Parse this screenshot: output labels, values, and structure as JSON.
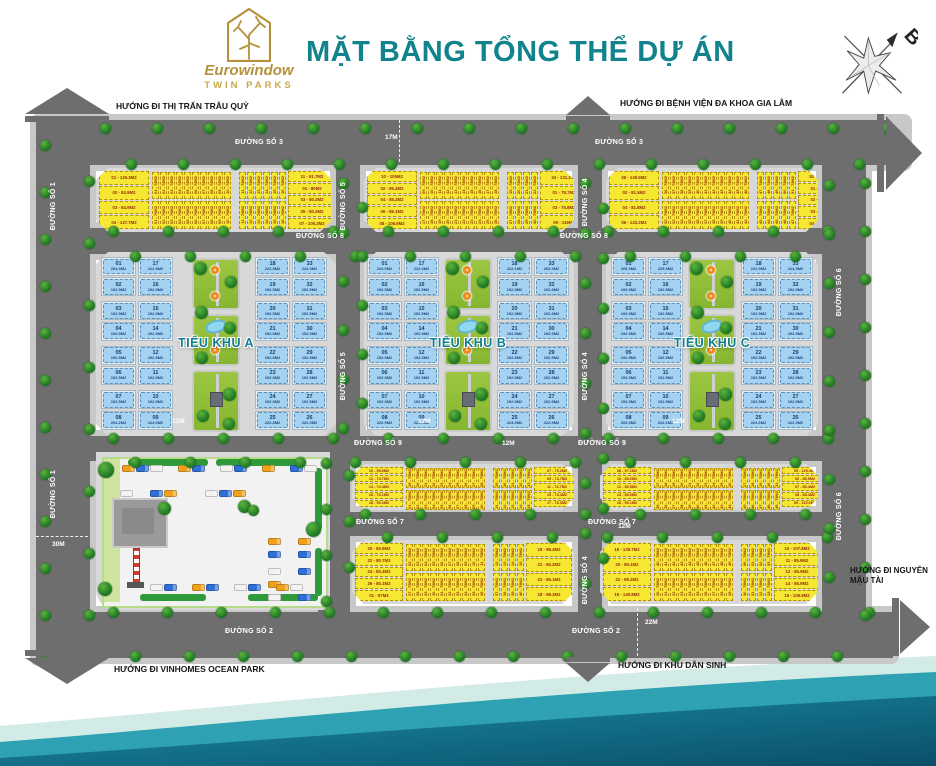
{
  "header": {
    "brand": "Eurowindow",
    "brand_sub": "TWIN PARKS",
    "title": "MẶT BẰNG TỔNG THỂ DỰ ÁN",
    "compass": "B"
  },
  "directions": {
    "trau_quy": "HƯỚNG ĐI THỊ TRẤN TRÂU QUỲ",
    "benh_vien": "HƯỚNG ĐI BỆNH VIỆN ĐA KHOA GIA LÂM",
    "vinhomes": "HƯỚNG ĐI VINHOMES OCEAN PARK",
    "khu_dan_sinh": "HƯỚNG ĐI KHU DÂN SINH",
    "nguyen_mau_tai": "HƯỚNG ĐI NGUYỄN MẬU TÀI"
  },
  "roads": {
    "d1": "ĐƯỜNG SỐ 1",
    "d2": "ĐƯỜNG SỐ 2",
    "d3": "ĐƯỜNG SỐ 3",
    "d4": "ĐƯỜNG SỐ 4",
    "d5": "ĐƯỜNG SỐ 5",
    "d6": "ĐƯỜNG SỐ 6",
    "d7": "ĐƯỜNG SỐ 7",
    "d8": "ĐƯỜNG SỐ 8",
    "d9": "ĐƯỜNG SỐ 9"
  },
  "dims": {
    "w12": "12M",
    "w17": "17M",
    "w22": "22M",
    "w30": "30M"
  },
  "zones": {
    "a": "TIỂU KHU A",
    "b": "TIỂU KHU B",
    "c": "TIỂU KHU C"
  },
  "colors": {
    "accent_teal": "#10838c",
    "gold": "#b5913c",
    "lot_yellow": "#f6e732",
    "lot_blue": "#a5d2f1",
    "road_gray": "#6e6e6e",
    "park_green": "#8fbe3a"
  },
  "blue_blocks": {
    "L1": {
      "rows": [
        [
          "01|204.3M2",
          "17|222.8M2"
        ],
        [
          "02|192.5M2",
          "16|192.5M2"
        ],
        [
          "03|192.5M2",
          "15|192.5M2"
        ],
        [
          "04|192.5M2",
          "14|192.5M2"
        ],
        [
          "05|192.5M2",
          "12|192.5M2"
        ],
        [
          "06|192.5M2",
          "11|192.5M2"
        ],
        [
          "07|192.5M2",
          "10|192.5M2"
        ],
        [
          "08|204.2M2",
          "09|224.6M2"
        ]
      ]
    },
    "L2": {
      "rows": [
        [
          "18|222.8M2",
          "33|224.3M2"
        ],
        [
          "19|192.5M2",
          "32|192.5M2"
        ],
        [
          "20|192.5M2",
          "31|192.5M2"
        ],
        [
          "21|192.5M2",
          "30|192.5M2"
        ],
        [
          "22|192.5M2",
          "29|192.5M2"
        ],
        [
          "23|192.5M2",
          "28|192.5M2"
        ],
        [
          "24|192.5M2",
          "27|192.5M2"
        ],
        [
          "25|222.8M2",
          "26|222.3M2"
        ]
      ]
    },
    "M1": {
      "rows": [
        [
          "01|224.9M2",
          "17|222.0M2"
        ],
        [
          "02|192.5M2",
          "16|192.5M2"
        ],
        [
          "03|192.5M2",
          "15|192.5M2"
        ],
        [
          "04|192.5M2",
          "14|192.5M2"
        ],
        [
          "05|192.5M2",
          "12|192.5M2"
        ],
        [
          "06|192.5M2",
          "11|192.5M2"
        ],
        [
          "07|192.5M2",
          "10|192.5M2"
        ],
        [
          "08|222.9M2",
          "09|224.9M2"
        ]
      ]
    },
    "M2": {
      "rows": [
        [
          "18|222.1M2",
          "33|203.3M2"
        ],
        [
          "19|192.5M2",
          "32|192.5M2"
        ],
        [
          "20|192.5M2",
          "31|192.5M2"
        ],
        [
          "21|192.5M2",
          "30|192.5M2"
        ],
        [
          "22|192.5M2",
          "29|192.5M2"
        ],
        [
          "23|192.5M2",
          "28|192.5M2"
        ],
        [
          "24|192.5M2",
          "27|192.5M2"
        ],
        [
          "25|224.0M2",
          "26|222.9M2"
        ]
      ]
    },
    "R1": {
      "rows": [
        [
          "01|205.3M2",
          "17|225.5M2"
        ],
        [
          "02|192.5M2",
          "16|192.5M2"
        ],
        [
          "03|192.5M2",
          "15|192.5M2"
        ],
        [
          "04|192.5M2",
          "14|192.5M2"
        ],
        [
          "05|192.5M2",
          "12|192.5M2"
        ],
        [
          "06|192.5M2",
          "11|192.5M2"
        ],
        [
          "07|192.5M2",
          "10|192.5M2"
        ],
        [
          "08|203.3M2",
          "09|222.1M2"
        ]
      ]
    },
    "R2": {
      "rows": [
        [
          "18|222.9M2",
          "33|224.5M2"
        ],
        [
          "19|192.5M2",
          "32|192.5M2"
        ],
        [
          "20|192.5M2",
          "31|192.5M2"
        ],
        [
          "21|192.5M2",
          "30|192.5M2"
        ],
        [
          "22|192.5M2",
          "29|192.5M2"
        ],
        [
          "23|192.5M2",
          "28|192.5M2"
        ],
        [
          "24|192.5M2",
          "27|192.5M2"
        ],
        [
          "25|224.6M2",
          "26|222.9M2"
        ]
      ]
    }
  },
  "yellow_blocks": {
    "Y1": {
      "left": [
        "01 - 125.3M2",
        "02 - 84.9M2",
        "03 - 84.9M2",
        "04 - 127.7M2"
      ],
      "right": [
        "11 - 91.7M2",
        "01 - 80M2",
        "03 - 80.2M2",
        "05 - 80.3M2",
        "07 - 100.2M2"
      ],
      "top": [
        "01 - 75M2",
        "02 - 75M2",
        "03 - 75M2",
        "04 - 75M2",
        "05 - 75M2",
        "06 - 75M2",
        "07 - 75M2",
        "08 - 75M2",
        "09 - 75M2",
        "10 - 75M2",
        "11 - 75M2",
        "12 - 75M2",
        "13 - 75M2",
        "14 - 75M2",
        "15 - 75M2",
        "16 - 75M2"
      ],
      "bottom": [
        "01 - 75M2",
        "02 - 75M2",
        "03 - 75M2",
        "04 - 75M2",
        "05 - 75M2",
        "06 - 75M2",
        "07 - 75M2",
        "08 - 75M2",
        "09 - 75M2",
        "10 - 75M2",
        "11 - 75M2",
        "12 - 75M2",
        "13 - 75M2",
        "14 - 75M2",
        "15 - 75M2",
        "16 - 75M2"
      ],
      "gap": 10
    },
    "Y2": {
      "left": [
        "10 - 105M2",
        "02 - 85.4M2",
        "04 - 85.2M2",
        "06 - 85.1M2",
        "08 - 106.6M2"
      ],
      "right": [
        "34 - 131.2M2",
        "01 - 78.7M2",
        "03 - 75.8M2",
        "05 - 116M2"
      ],
      "top": [
        "09 - 75M2",
        "10 - 75M2",
        "11 - 75M2",
        "12 - 75M2",
        "13 - 75M2",
        "14 - 75M2",
        "15 - 75M2",
        "16 - 75M2",
        "17 - 75M2",
        "18 - 75M2",
        "19 - 75M2",
        "20 - 75M2",
        "21 - 75M2",
        "22 - 75M2"
      ],
      "bottom": [
        "17 - 75M2",
        "18 - 75M2",
        "19 - 75M2",
        "20 - 75M2",
        "21 - 75M2",
        "22 - 75M2",
        "23 - 75M2",
        "24 - 75M2",
        "25 - 75M2",
        "26 - 75M2",
        "27 - 75M2",
        "28 - 75M2",
        "29 - 75M2",
        "30 - 75M2"
      ],
      "gap": 10
    },
    "Y3": {
      "left": [
        "35 - 139.5M2",
        "02 - 81.5M2",
        "04 - 81.8M2",
        "06 - 133.2M2"
      ],
      "right": [
        "52 - 105.7M2",
        "01 - 85.4M2",
        "02 - 85.3M2",
        "03 - 85.1M2",
        "04 - 105.1M2"
      ],
      "top": [
        "36 - 75M2",
        "37 - 75M2",
        "38 - 75M2",
        "39 - 75M2",
        "40 - 75M2",
        "41 - 75M2",
        "42 - 75M2",
        "43 - 75M2",
        "44 - 75M2",
        "45 - 75M2",
        "46 - 75M2",
        "47 - 75M2",
        "48 - 75M2",
        "49 - 75M2",
        "50 - 75M2",
        "51 - 75M2"
      ],
      "bottom": [
        "32 - 75M2",
        "33 - 75M2",
        "34 - 75M2",
        "35 - 75M2",
        "36 - 75M2",
        "37 - 75M2",
        "38 - 75M2",
        "39 - 75M2",
        "40 - 75M2",
        "41 - 75M2",
        "42 - 75M2",
        "43 - 75M2",
        "44 - 75M2",
        "45 - 75M2",
        "46 - 75M2",
        "47 - 75M2"
      ],
      "gap": 11
    },
    "WA1": {
      "left": [
        "10 - 95.6M2",
        "12 - 74.7M2",
        "14 - 74.4M2",
        "16 - 74.1M2",
        "18 - 93.2M2"
      ],
      "right": [
        "07 - 75.2M2",
        "09 - 74.7M2",
        "11 - 74.7M2",
        "15 - 74.4M2",
        "17 - 76.3M2"
      ],
      "top": [
        "19 - 75M2",
        "20 - 75M2",
        "21 - 75M2",
        "22 - 75M2",
        "23 - 75M2",
        "24 - 75M2",
        "25 - 75M2",
        "26 - 75M2",
        "27 - 75M2",
        "28 - 75M2",
        "29 - 75M2",
        "30 - 75M2",
        "31 - 75M2",
        "32 - 75M2",
        "33 - 75M2"
      ],
      "bottom": [
        "01 - 75M2",
        "02 - 75M2",
        "03 - 75M2",
        "04 - 75M2",
        "05 - 75M2",
        "06 - 75M2",
        "07 - 75M2",
        "08 - 75M2",
        "09 - 75M2",
        "10 - 75M2",
        "11 - 75M2",
        "12 - 75M2",
        "13 - 75M2",
        "14 - 75M2",
        "15 - 75M2"
      ],
      "gap": 10
    },
    "WA2": {
      "left": [
        "08 - 97.1M2",
        "10 - 85.2M2",
        "12 - 85.5M2",
        "14 - 85.6M2",
        "16 - 96.1M2"
      ],
      "right": [
        "05 - 125.4M2",
        "06 - 85.5M2",
        "07 - 85.4M2",
        "08 - 85.4M2",
        "09 - 115.6M2"
      ],
      "top": [
        "17 - 75M2",
        "18 - 75M2",
        "19 - 75M2",
        "20 - 75M2",
        "21 - 75M2",
        "22 - 75M2",
        "23 - 75M2",
        "24 - 75M2",
        "25 - 75M2",
        "26 - 75M2",
        "27 - 75M2",
        "28 - 75M2",
        "29 - 75M2",
        "30 - 75M2",
        "31 - 75M2"
      ],
      "bottom": [
        "35 - 75M2",
        "36 - 75M2",
        "37 - 75M2",
        "38 - 75M2",
        "39 - 75M2",
        "40 - 75M2",
        "41 - 75M2",
        "42 - 75M2",
        "43 - 75M2",
        "44 - 75M2",
        "45 - 75M2",
        "46 - 75M2",
        "47 - 75M2",
        "48 - 75M2",
        "49 - 75M2"
      ],
      "gap": 10
    },
    "WB1": {
      "left": [
        "20 - 80.9M2",
        "22 - 80.7M2",
        "24 - 80.4M2",
        "26 - 80.1M2",
        "01 - 97M2"
      ],
      "right": [
        "19 - 98.4M2",
        "21 - 65.2M2",
        "23 - 65.1M2",
        "18 - 98.3M2"
      ],
      "top": [
        "02 - 75M2",
        "03 - 75M2",
        "04 - 75M2",
        "05 - 75M2",
        "06 - 75M2",
        "07 - 75M2",
        "08 - 75M2",
        "09 - 75M2",
        "10 - 75M2",
        "11 - 75M2",
        "12 - 75M2",
        "13 - 75M2",
        "14 - 75M2",
        "15 - 75M2"
      ],
      "bottom": [
        "27 - 75M2",
        "28 - 75M2",
        "29 - 75M2",
        "30 - 75M2",
        "31 - 75M2",
        "32 - 75M2",
        "33 - 75M2",
        "34 - 75M2",
        "35 - 75M2",
        "36 - 75M2",
        "37 - 75M2",
        "38 - 75M2",
        "39 - 75M2",
        "40 - 75M2"
      ],
      "gap": 10
    },
    "WB2": {
      "left": [
        "18 - 139.7M2",
        "20 - 89.1M2",
        "22 - 89.2M2",
        "19 - 140.8M2"
      ],
      "right": [
        "10 - 107.8M2",
        "11 - 85.9M2",
        "12 - 85.9M2",
        "14 - 85.9M2",
        "15 - 105.9M2"
      ],
      "top": [
        "40 - 75M2",
        "41 - 75M2",
        "42 - 75M2",
        "43 - 75M2",
        "44 - 75M2",
        "45 - 75M2",
        "46 - 75M2",
        "47 - 75M2",
        "48 - 75M2",
        "49 - 75M2",
        "50 - 75M2",
        "51 - 75M2",
        "52 - 75M2",
        "53 - 75M2"
      ],
      "bottom": [
        "20 - 75M2",
        "21 - 75M2",
        "22 - 75M2",
        "23 - 75M2",
        "24 - 75M2",
        "25 - 75M2",
        "26 - 75M2",
        "27 - 75M2",
        "28 - 75M2",
        "29 - 75M2",
        "30 - 75M2",
        "31 - 75M2",
        "32 - 75M2",
        "33 - 75M2"
      ],
      "gap": 10
    }
  }
}
